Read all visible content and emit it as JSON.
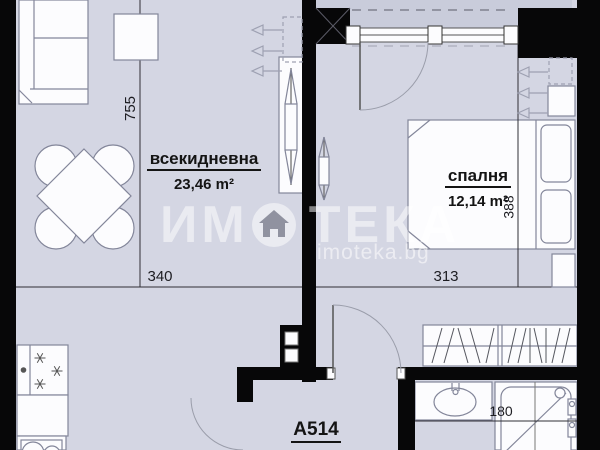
{
  "floor_plan": {
    "unit_label": "A514",
    "rooms": {
      "living": {
        "name": "всекидневна",
        "area": "23,46 m²"
      },
      "bedroom": {
        "name": "спалня",
        "area": "12,14 m²"
      }
    },
    "dimensions": {
      "living_vertical": "755",
      "living_horizontal": "340",
      "bedroom_horizontal": "313",
      "bedroom_vertical": "388",
      "bathroom_width": "180"
    }
  },
  "watermark": {
    "brand_prefix": "ИМ",
    "brand_suffix": "ТЕКА",
    "brand_icon": "house-in-circle-icon",
    "website": "imoteka.bg"
  },
  "colors": {
    "floor": "#d4d6e3",
    "balcony_floor": "#c9ccdb",
    "wall": "#070708",
    "furniture_fill": "#fcfcfe",
    "furniture_stroke": "#83869a",
    "dimension_line": "#2f2f35",
    "watermark_white": "rgba(255,255,255,0.55)"
  }
}
